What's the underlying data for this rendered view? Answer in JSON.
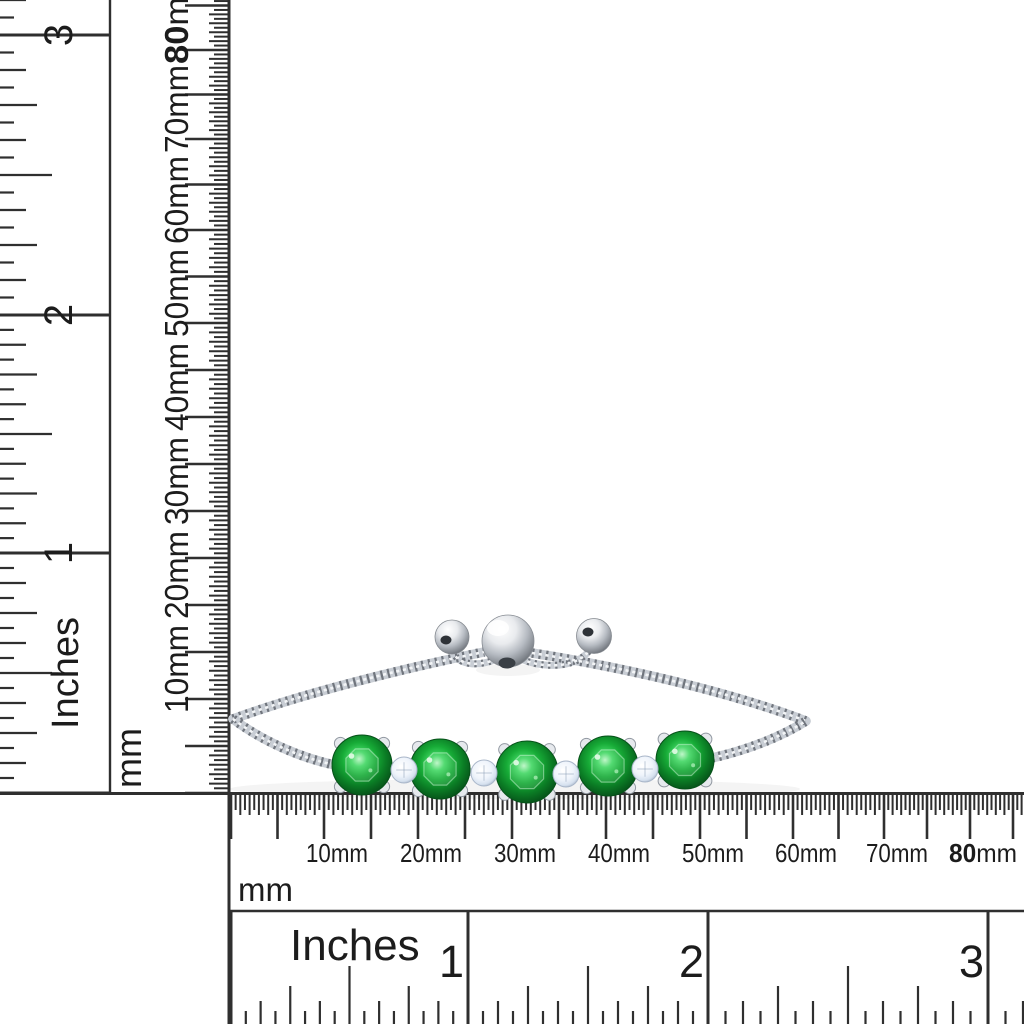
{
  "canvas": {
    "width": 1024,
    "height": 1024,
    "background": "#ffffff"
  },
  "palette": {
    "ruler_ink": "#2f2f2f",
    "label_ink": "#1c1c1c",
    "gem_green_core": "#b8f6c3",
    "gem_green_bright": "#41d763",
    "gem_green_mid": "#17ab37",
    "gem_green_deep": "#0b7d25",
    "gem_green_rim": "#065119",
    "accent_stone": "#eff4fb",
    "accent_stone_rim": "#aebbcd",
    "silver_highlight": "#f4f6f8",
    "silver_mid": "#c8cdd4",
    "silver_dark": "#767b83",
    "silver_deep": "#41464d"
  },
  "rulers": {
    "vertical_inches": {
      "unit": "Inches",
      "zero_pos": 793,
      "marks": [
        {
          "label": "1",
          "pos": 553
        },
        {
          "label": "2",
          "pos": 315
        },
        {
          "label": "3",
          "pos": 35
        }
      ]
    },
    "vertical_mm": {
      "unit": "mm",
      "zero_pos": 793,
      "marks": [
        {
          "num": "10",
          "unit": "mm",
          "pos": 699
        },
        {
          "num": "20",
          "unit": "mm",
          "pos": 605
        },
        {
          "num": "30",
          "unit": "mm",
          "pos": 511
        },
        {
          "num": "40",
          "unit": "mm",
          "pos": 417
        },
        {
          "num": "50",
          "unit": "mm",
          "pos": 323
        },
        {
          "num": "60",
          "unit": "mm",
          "pos": 230
        },
        {
          "num": "70",
          "unit": "mm",
          "pos": 139
        },
        {
          "num": "80",
          "unit": "mm",
          "pos": 50,
          "bold": true
        }
      ]
    },
    "horizontal_mm": {
      "unit": "mm",
      "zero_pos": 231,
      "marks": [
        {
          "num": "10",
          "unit": "mm",
          "pos": 324
        },
        {
          "num": "20",
          "unit": "mm",
          "pos": 418
        },
        {
          "num": "30",
          "unit": "mm",
          "pos": 512
        },
        {
          "num": "40",
          "unit": "mm",
          "pos": 606
        },
        {
          "num": "50",
          "unit": "mm",
          "pos": 700
        },
        {
          "num": "60",
          "unit": "mm",
          "pos": 793
        },
        {
          "num": "70",
          "unit": "mm",
          "pos": 884
        },
        {
          "num": "80",
          "unit": "mm",
          "pos": 970,
          "bold": true
        }
      ]
    },
    "horizontal_inches": {
      "unit": "Inches",
      "zero_pos": 231,
      "marks": [
        {
          "label": "1",
          "pos": 468
        },
        {
          "label": "2",
          "pos": 708
        },
        {
          "label": "3",
          "pos": 988
        }
      ]
    }
  },
  "bracelet": {
    "green_stone_count": 5,
    "accent_stone_count": 4,
    "green_stones": [
      {
        "x": 362,
        "y": 765,
        "r": 30
      },
      {
        "x": 440,
        "y": 769,
        "r": 30
      },
      {
        "x": 527,
        "y": 772,
        "r": 31
      },
      {
        "x": 608,
        "y": 766,
        "r": 30
      },
      {
        "x": 685,
        "y": 760,
        "r": 29
      }
    ],
    "accent_stones": [
      {
        "x": 404,
        "y": 770,
        "r": 13
      },
      {
        "x": 484,
        "y": 773,
        "r": 13
      },
      {
        "x": 566,
        "y": 774,
        "r": 13
      },
      {
        "x": 645,
        "y": 769,
        "r": 13
      }
    ]
  }
}
